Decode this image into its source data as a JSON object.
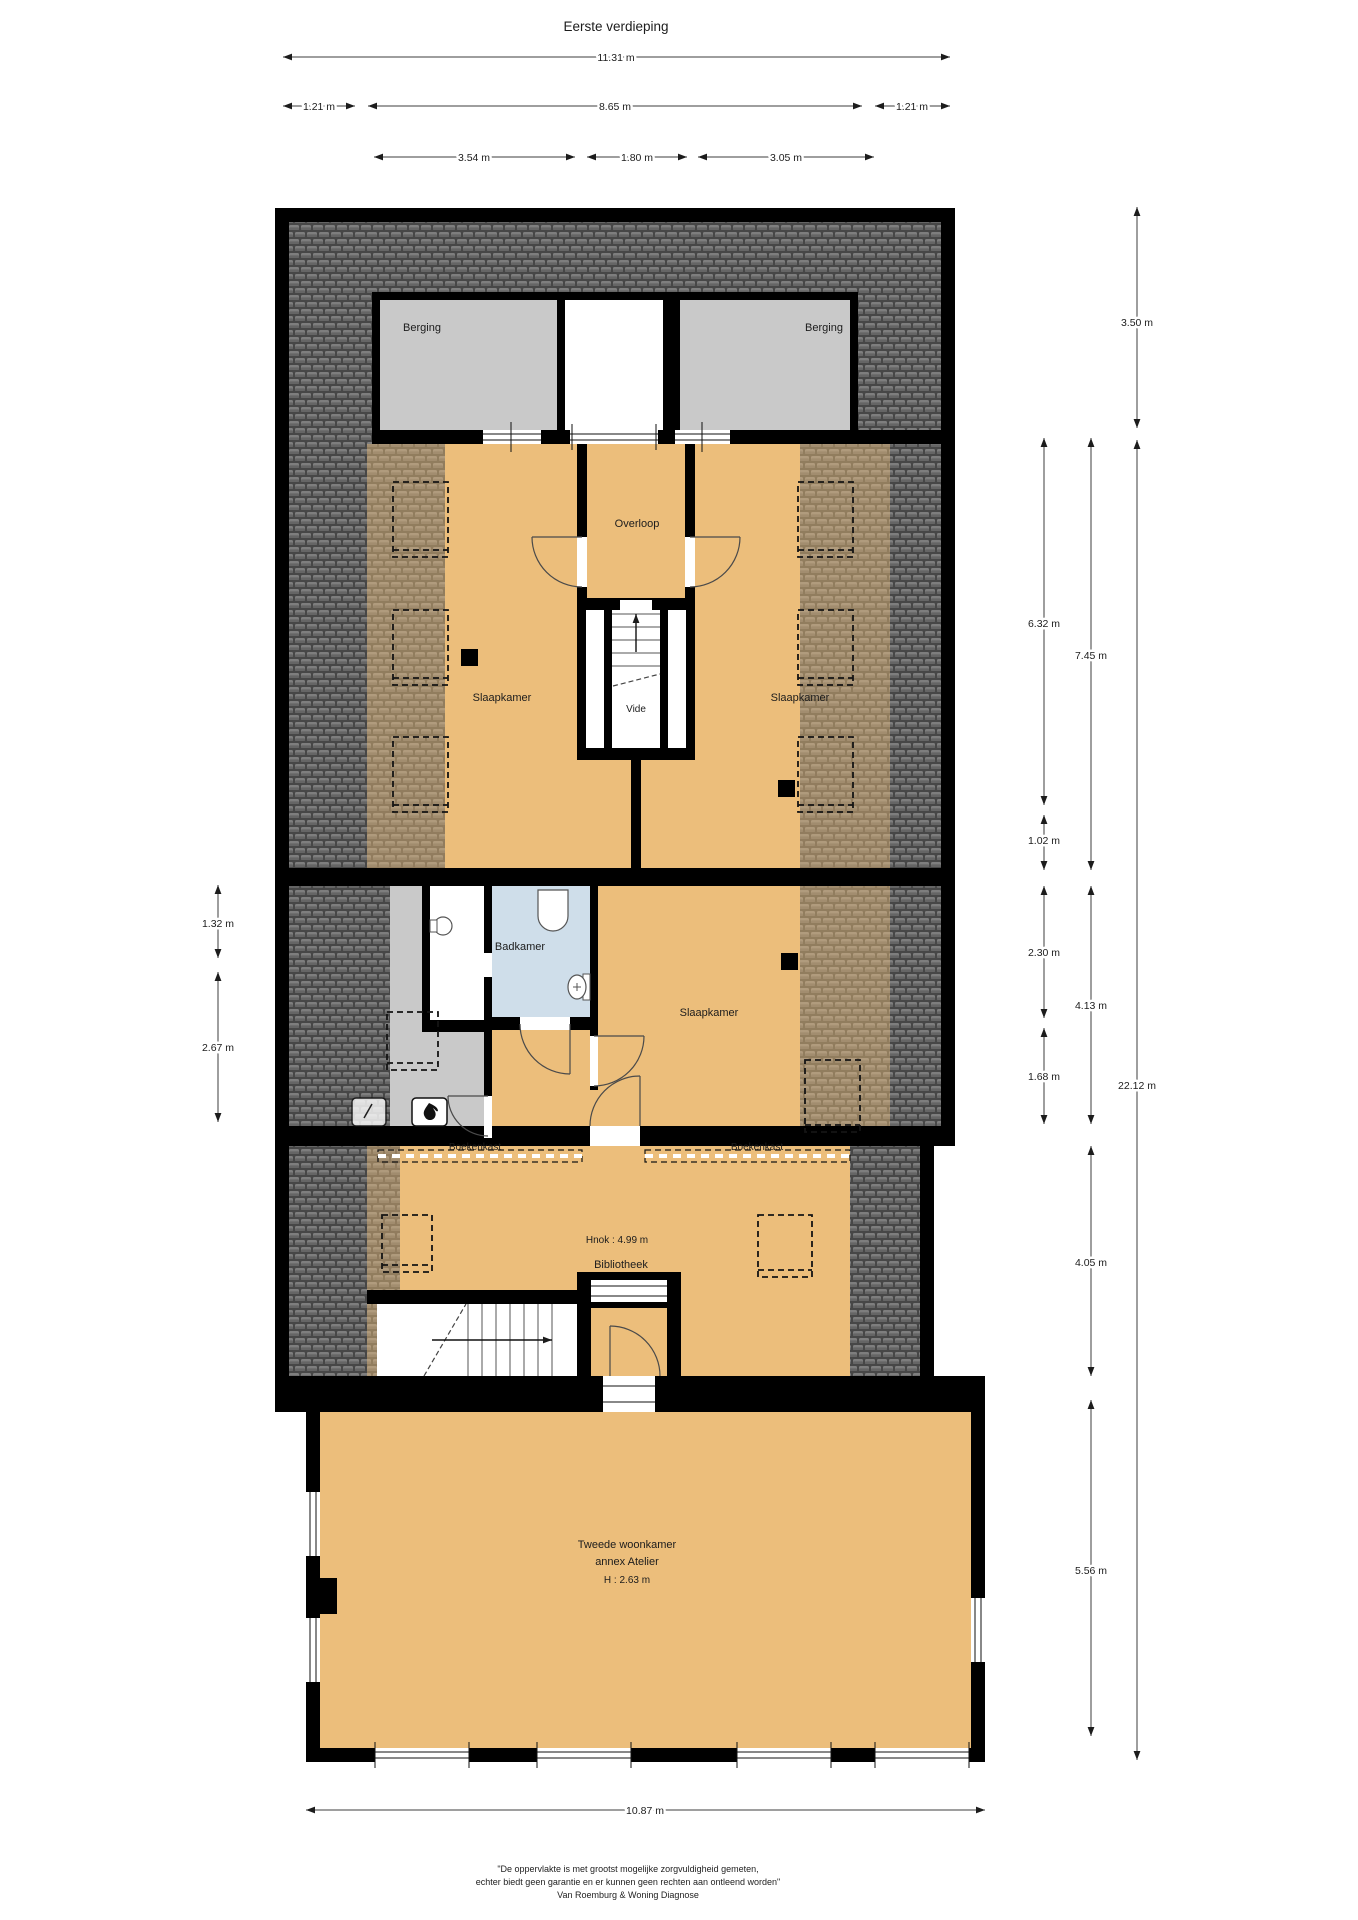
{
  "title": "Eerste verdieping",
  "dims": {
    "w_total": "11.31 m",
    "w_left": "1.21 m",
    "w_mid": "8.65 m",
    "w_right": "1.21 m",
    "w_a": "3.54 m",
    "w_b": "1.80 m",
    "w_c": "3.05 m",
    "r_350": "3.50 m",
    "r_632": "6.32 m",
    "r_745": "7.45 m",
    "r_102": "1.02 m",
    "r_230": "2.30 m",
    "r_413": "4.13 m",
    "r_168": "1.68 m",
    "r_2212": "22.12 m",
    "r_405": "4.05 m",
    "r_556": "5.56 m",
    "l_132": "1.32 m",
    "l_267": "2.67 m",
    "b_1087": "10.87 m"
  },
  "rooms": {
    "berging_left": "Berging",
    "berging_right": "Berging",
    "overloop": "Overloop",
    "slaapkamer_left": "Slaapkamer",
    "slaapkamer_right": "Slaapkamer",
    "slaapkamer_mid": "Slaapkamer",
    "vide": "Vide",
    "badkamer": "Badkamer",
    "boekenkast_left": "Boekenkast",
    "boekenkast_right": "Boekenkast",
    "hnok": "Hnok : 4.99 m",
    "bibliotheek": "Bibliotheek",
    "woonkamer_1": "Tweede woonkamer",
    "woonkamer_2": "annex Atelier",
    "woonkamer_h": "H : 2.63 m"
  },
  "colors": {
    "floor_orange": "#ecbe7b",
    "storage_gray": "#c9c9c9",
    "bath_blue": "#cfdeea",
    "roof_dark": "#474747",
    "roof_tile": "#7e7e7e",
    "wall_black": "#000000"
  },
  "footer": {
    "line1": "\"De oppervlakte is met grootst mogelijke zorgvuldigheid gemeten,",
    "line2": "echter biedt geen garantie en er kunnen geen rechten aan ontleend worden\"",
    "line3": "Van Roemburg & Woning Diagnose"
  }
}
